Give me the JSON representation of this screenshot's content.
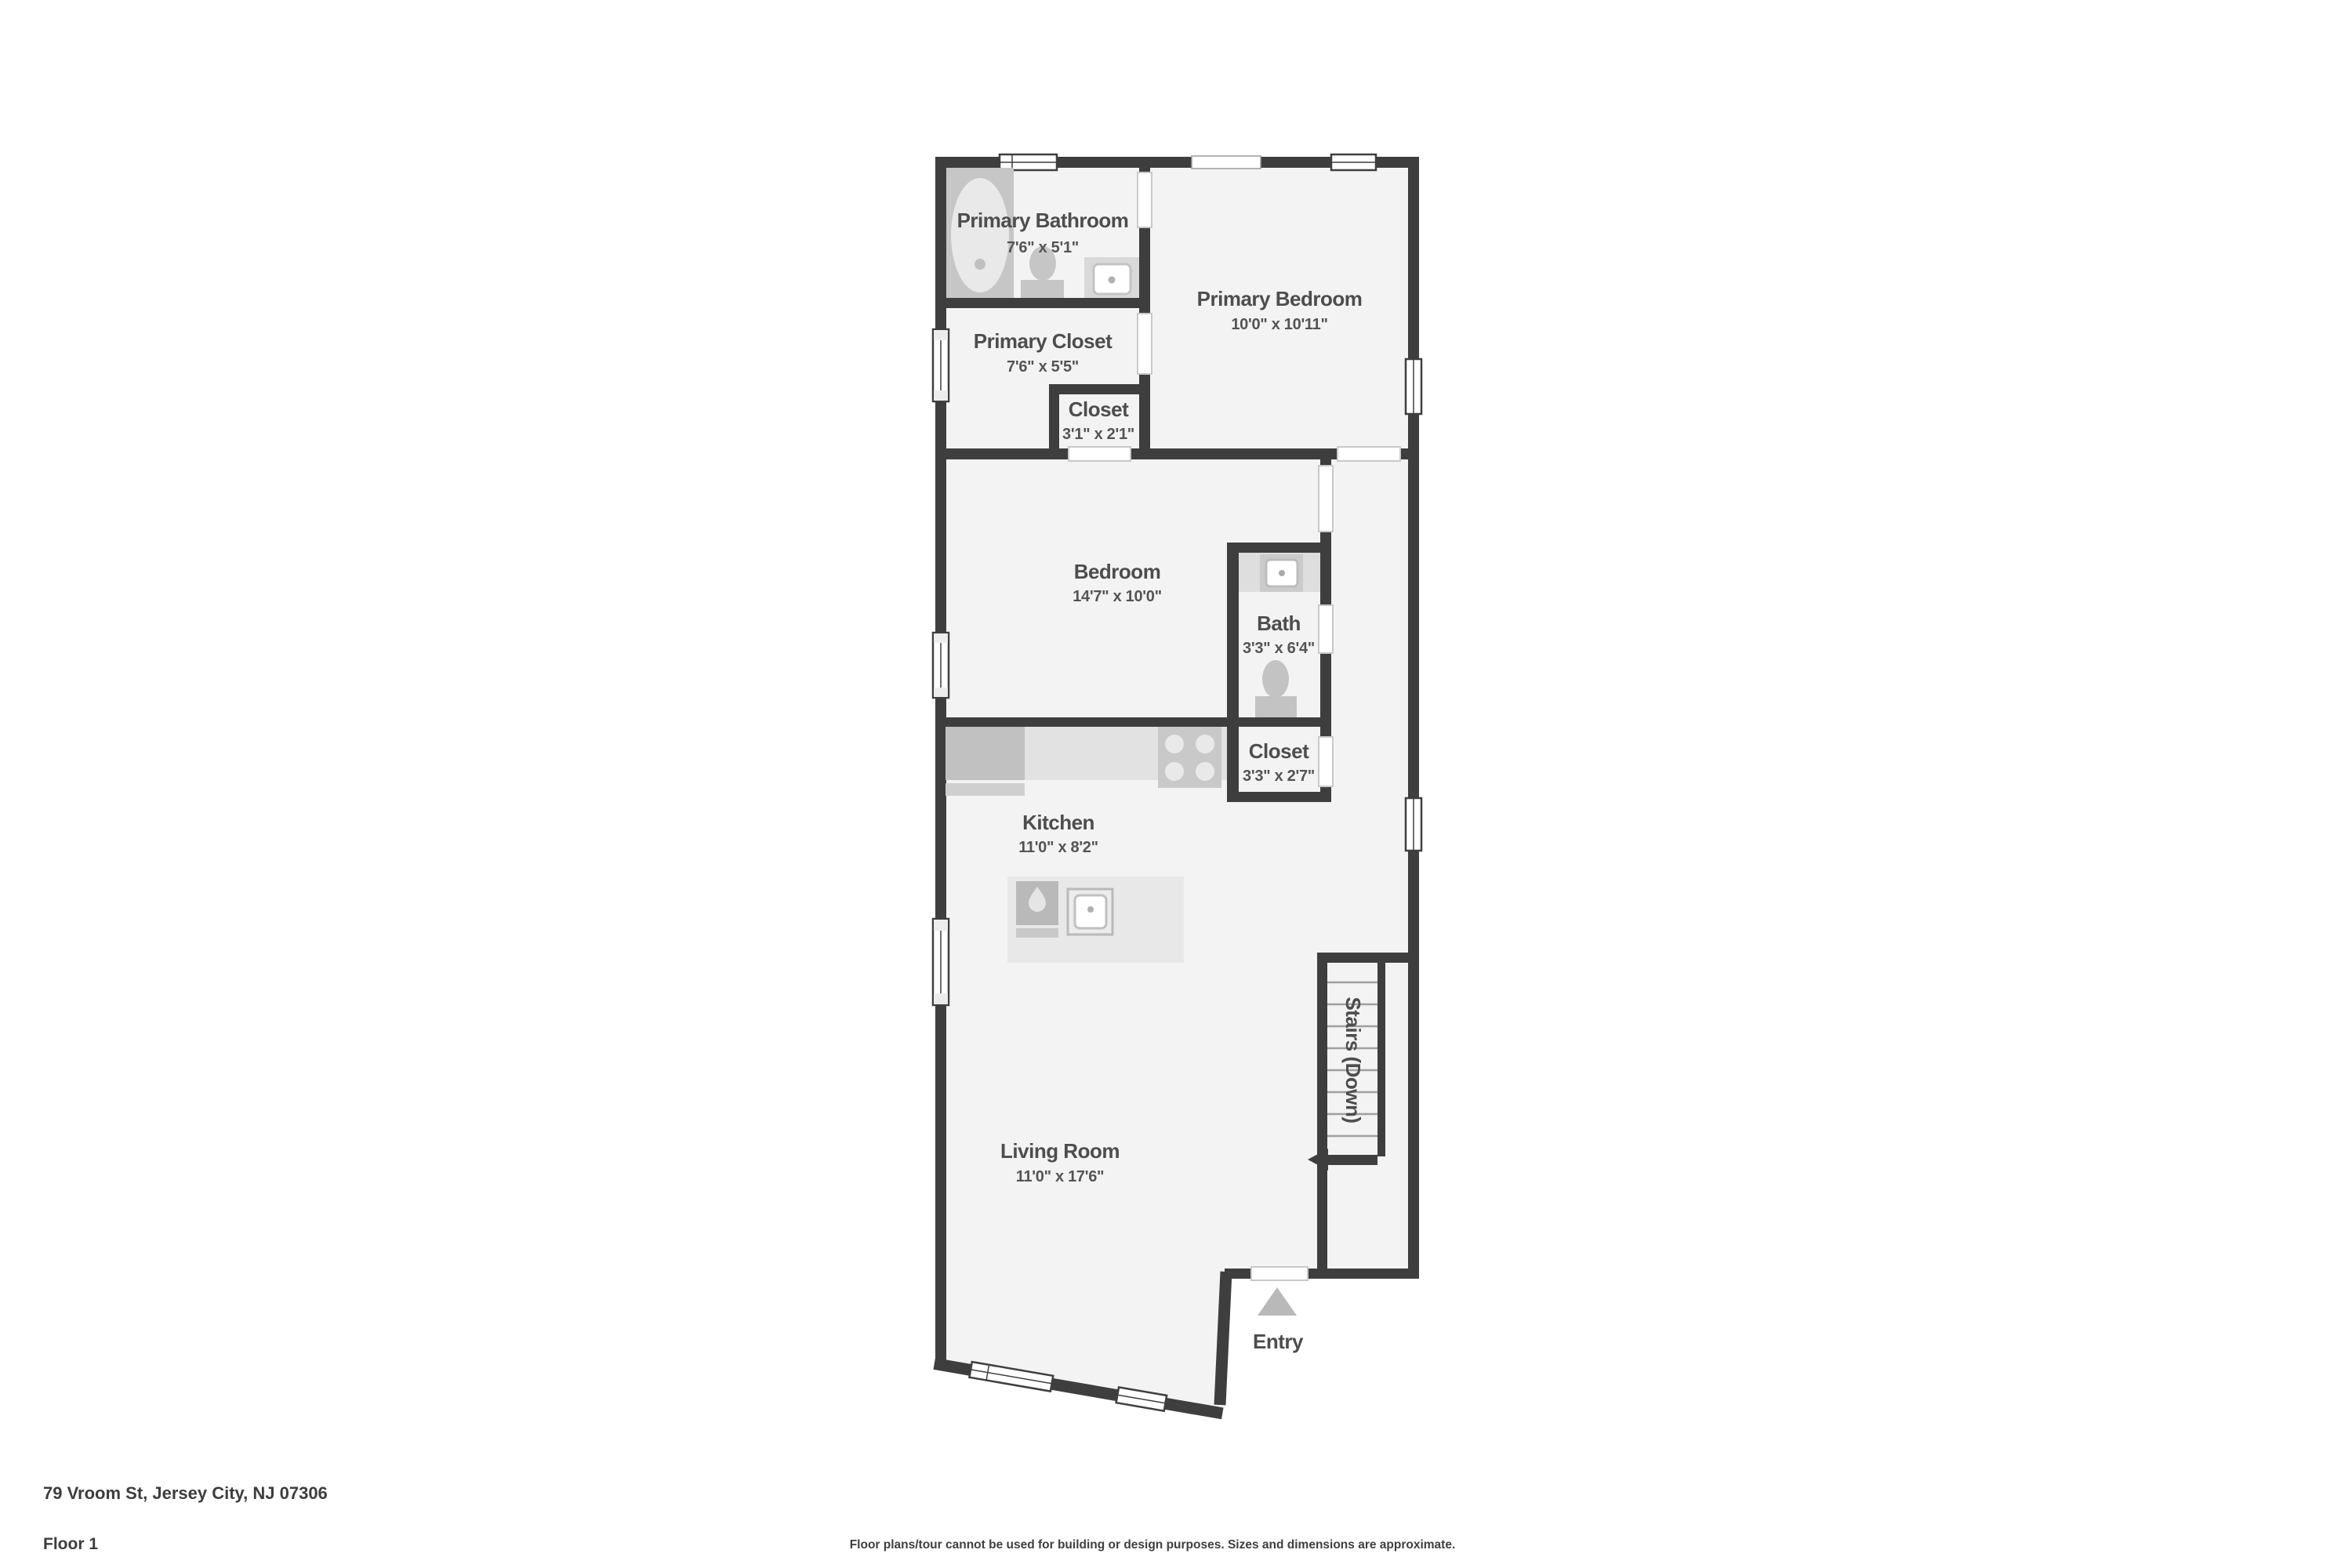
{
  "page": {
    "address": "79 Vroom St, Jersey City, NJ 07306",
    "floor_label": "Floor 1",
    "disclaimer": "Floor plans/tour cannot be used for building or design purposes. Sizes and dimensions are approximate."
  },
  "plan": {
    "rooms": [
      {
        "name": "Primary Bathroom",
        "dims": "7'6\" x 5'1\""
      },
      {
        "name": "Primary Bedroom",
        "dims": "10'0\" x 10'11\""
      },
      {
        "name": "Primary Closet",
        "dims": "7'6\" x 5'5\""
      },
      {
        "name": "Closet",
        "dims": "3'1\" x 2'1\""
      },
      {
        "name": "Bedroom",
        "dims": "14'7\" x 10'0\""
      },
      {
        "name": "Bath",
        "dims": "3'3\" x 6'4\""
      },
      {
        "name": "Closet",
        "dims": "3'3\" x 2'7\""
      },
      {
        "name": "Kitchen",
        "dims": "11'0\" x 8'2\""
      },
      {
        "name": "Living Room",
        "dims": "11'0\" x 17'6\""
      }
    ],
    "stairs_label": "Stairs (Down)",
    "entry_label": "Entry"
  },
  "colors": {
    "wall": "#3E3E3E",
    "floor": "#F3F3F3",
    "fixture": "#C6C6C6",
    "label_text": "#4D4D4D"
  }
}
